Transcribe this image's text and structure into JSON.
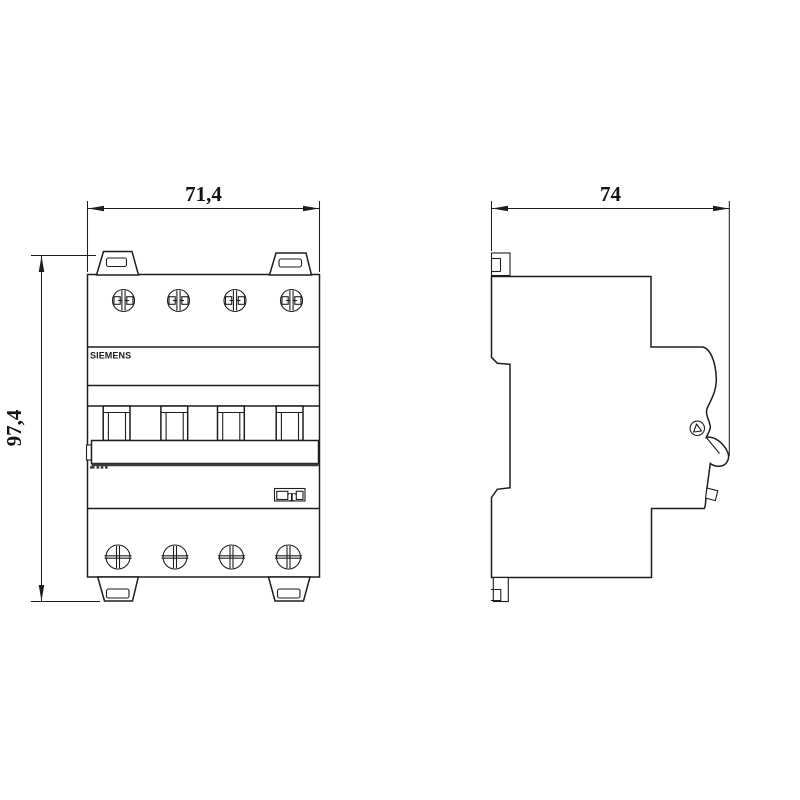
{
  "views": {
    "front": {
      "brand": "SIEMENS",
      "width_label": "71,4",
      "height_label": "97,4",
      "test_button": "T"
    },
    "side": {
      "depth_label": "74"
    }
  },
  "colors": {
    "line": "#1e1e1e",
    "background": "#ffffff"
  }
}
